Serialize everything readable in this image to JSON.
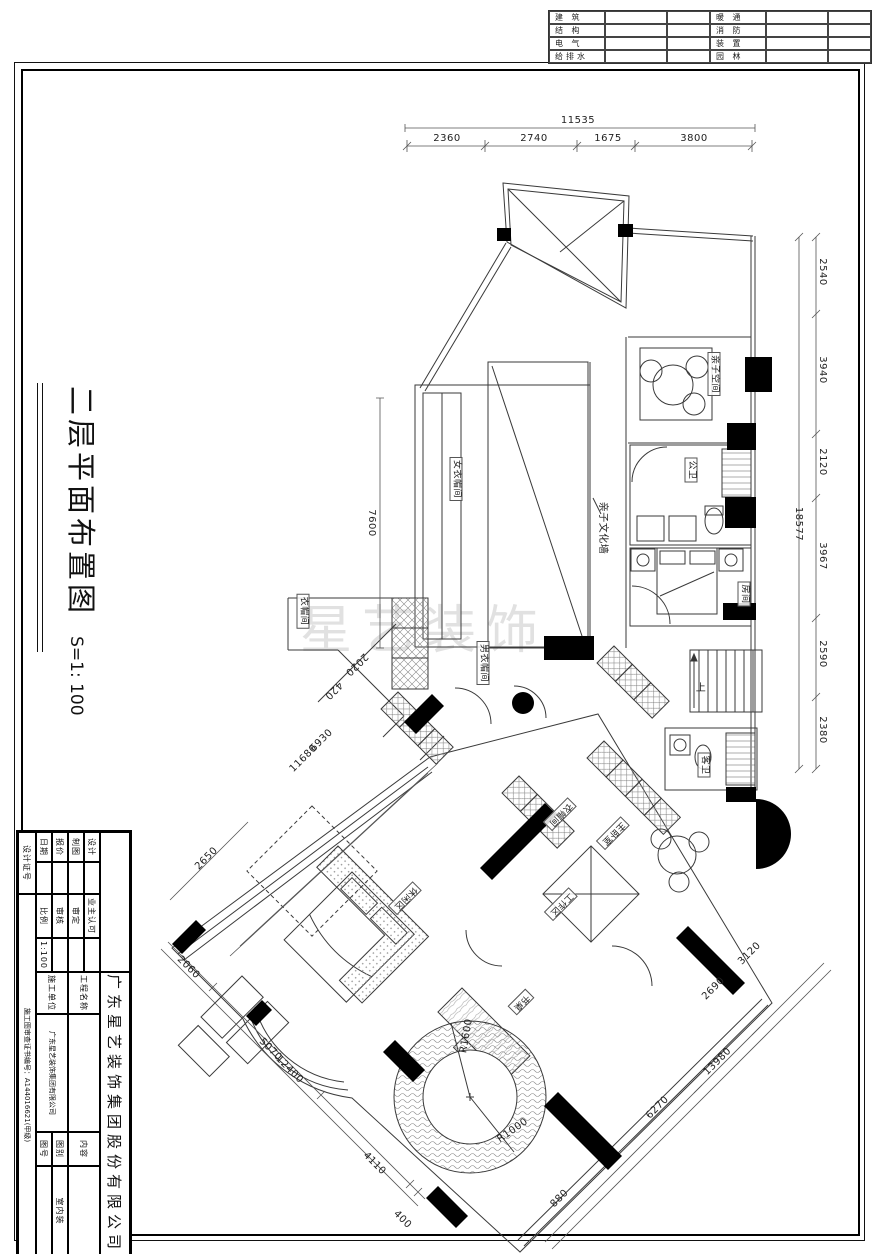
{
  "disciplines": {
    "rows": [
      [
        "建 筑",
        "暖 通"
      ],
      [
        "结 构",
        "消 防"
      ],
      [
        "电 气",
        "装 置"
      ],
      [
        "给排水",
        "园 林"
      ]
    ]
  },
  "side_title": {
    "text": "二层平面布置图",
    "scale": "S=1: 100"
  },
  "title_block": {
    "company": "广东星艺装饰集团股份有限公司",
    "design": "设计",
    "draft": "制图",
    "quote": "报价",
    "date": "日期",
    "owner": "业主认可",
    "approved": "审定",
    "checked": "审核",
    "scale_label": "比例",
    "scale": "1:100",
    "project_label": "工程名称",
    "builder_label": "施工单位",
    "builder": "广东星艺装饰集团有限公司",
    "content_label": "内容",
    "category_label": "图别",
    "category": "室内装",
    "sheet_no_label": "图号",
    "cert_no_label": "设计证号",
    "cert": "施工图审查证书编号：A144016621(甲级)"
  },
  "plan": {
    "watermark": "星艺装饰",
    "room_labels": [
      {
        "t": "亲子空间",
        "x": 714,
        "y": 374,
        "r": 90,
        "boxed": true
      },
      {
        "t": "公卫",
        "x": 691,
        "y": 470,
        "r": 90,
        "boxed": true
      },
      {
        "t": "亲子文化墙",
        "x": 602,
        "y": 528,
        "r": 90,
        "boxed": false
      },
      {
        "t": "女衣帽间",
        "x": 456,
        "y": 479,
        "r": 90,
        "boxed": true
      },
      {
        "t": "衣帽间",
        "x": 303,
        "y": 611,
        "r": 90,
        "boxed": true
      },
      {
        "t": "男衣帽间",
        "x": 483,
        "y": 663,
        "r": 90,
        "boxed": true
      },
      {
        "t": "房间",
        "x": 744,
        "y": 594,
        "r": 90,
        "boxed": true
      },
      {
        "t": "客卫",
        "x": 704,
        "y": 765,
        "r": 90,
        "boxed": true
      },
      {
        "t": "上",
        "x": 701,
        "y": 689,
        "r": 0,
        "boxed": false
      },
      {
        "t": "衣帽间",
        "x": 560,
        "y": 814,
        "r": 135,
        "boxed": true
      },
      {
        "t": "主卧室",
        "x": 613,
        "y": 833,
        "r": 135,
        "boxed": true
      },
      {
        "t": "工作区",
        "x": 561,
        "y": 904,
        "r": 135,
        "boxed": true
      },
      {
        "t": "休闲区",
        "x": 405,
        "y": 898,
        "r": 135,
        "boxed": true
      },
      {
        "t": "书桌",
        "x": 521,
        "y": 1002,
        "r": 135,
        "boxed": true
      }
    ],
    "dimensions": [
      {
        "t": "11535",
        "x": 578,
        "y": 121,
        "r": 0
      },
      {
        "t": "2360",
        "x": 447,
        "y": 139,
        "r": 0
      },
      {
        "t": "2740",
        "x": 534,
        "y": 139,
        "r": 0
      },
      {
        "t": "1675",
        "x": 608,
        "y": 139,
        "r": 0
      },
      {
        "t": "3800",
        "x": 694,
        "y": 139,
        "r": 0
      },
      {
        "t": "2540",
        "x": 822,
        "y": 272,
        "r": 90
      },
      {
        "t": "3940",
        "x": 822,
        "y": 370,
        "r": 90
      },
      {
        "t": "2120",
        "x": 822,
        "y": 462,
        "r": 90
      },
      {
        "t": "18577",
        "x": 798,
        "y": 524,
        "r": 90
      },
      {
        "t": "3967",
        "x": 822,
        "y": 556,
        "r": 90
      },
      {
        "t": "2590",
        "x": 822,
        "y": 654,
        "r": 90
      },
      {
        "t": "2380",
        "x": 822,
        "y": 730,
        "r": 90
      },
      {
        "t": "7600",
        "x": 371,
        "y": 523,
        "r": 90
      },
      {
        "t": "2020",
        "x": 356,
        "y": 664,
        "r": 135
      },
      {
        "t": "420",
        "x": 333,
        "y": 690,
        "r": 135
      },
      {
        "t": "6930",
        "x": 322,
        "y": 741,
        "r": -45
      },
      {
        "t": "11680",
        "x": 304,
        "y": 759,
        "r": -45
      },
      {
        "t": "2650",
        "x": 207,
        "y": 859,
        "r": -45
      },
      {
        "t": "2060",
        "x": 188,
        "y": 968,
        "r": 45
      },
      {
        "t": "5070",
        "x": 270,
        "y": 1050,
        "r": 45
      },
      {
        "t": "12400",
        "x": 289,
        "y": 1070,
        "r": 45
      },
      {
        "t": "4110",
        "x": 374,
        "y": 1164,
        "r": 45
      },
      {
        "t": "400",
        "x": 402,
        "y": 1220,
        "r": 45
      },
      {
        "t": "3120",
        "x": 750,
        "y": 954,
        "r": -45
      },
      {
        "t": "2690",
        "x": 714,
        "y": 989,
        "r": -45
      },
      {
        "t": "13980",
        "x": 718,
        "y": 1062,
        "r": -45
      },
      {
        "t": "6270",
        "x": 658,
        "y": 1108,
        "r": -45
      },
      {
        "t": "880",
        "x": 560,
        "y": 1199,
        "r": -45
      },
      {
        "t": "R1600",
        "x": 467,
        "y": 1036,
        "r": -80
      },
      {
        "t": "R1000",
        "x": 513,
        "y": 1131,
        "r": -35
      }
    ]
  }
}
